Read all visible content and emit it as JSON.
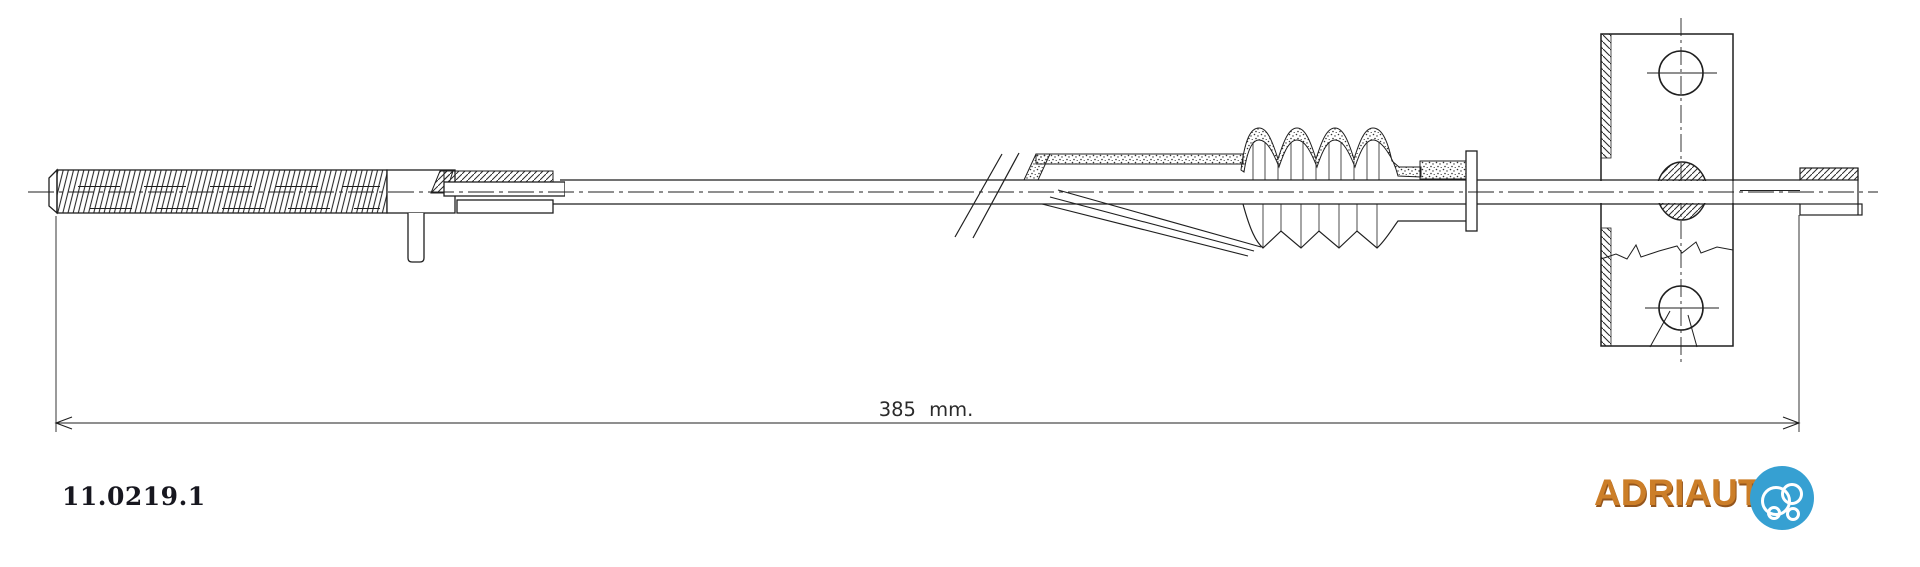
{
  "page": {
    "background_color": "#ffffff"
  },
  "drawing": {
    "part_number": "11.0219.1",
    "dimension": {
      "label": "385 mm."
    },
    "line_color": "#1f1f1f"
  },
  "brand": {
    "wordmark": "ADRIAUT",
    "wordmark_color": "#cc7e28",
    "badge_color": "#36a0d2",
    "badge_icon": "bubble-car-logo"
  }
}
